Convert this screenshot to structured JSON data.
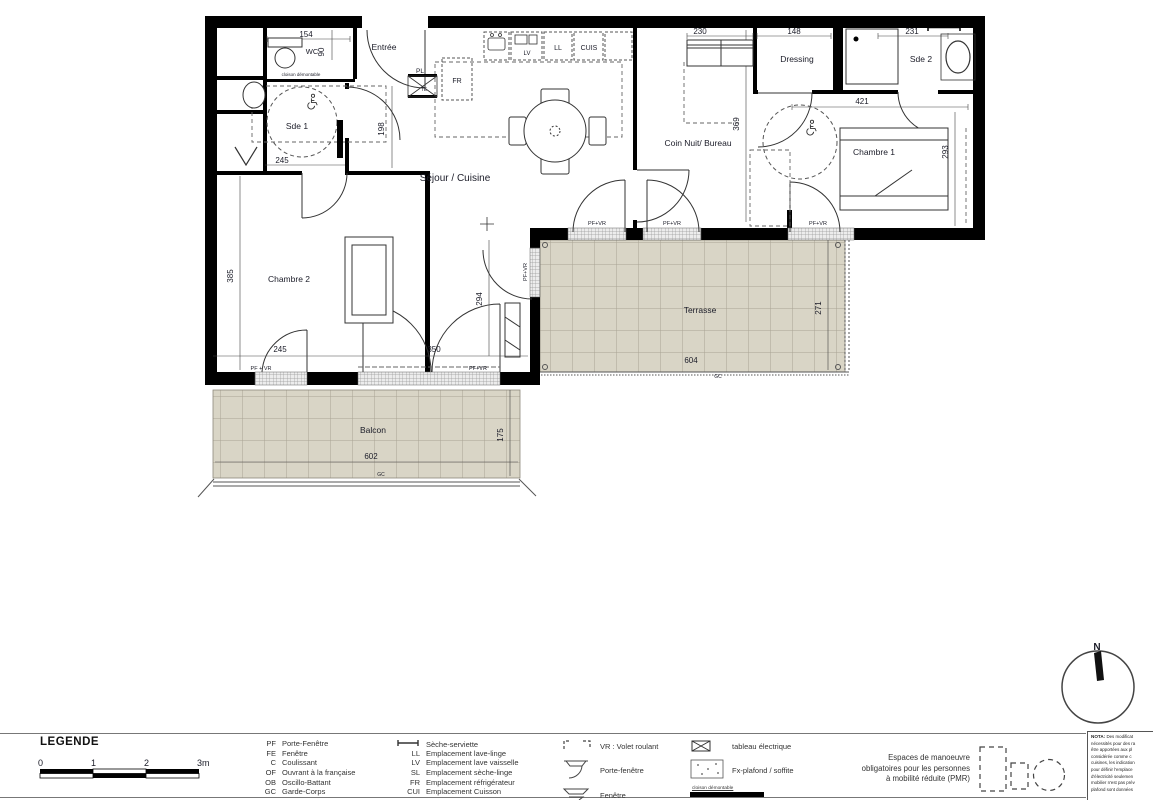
{
  "plan": {
    "rooms": {
      "wc": "WC",
      "entree": "Entrée",
      "sde1": "Sde 1",
      "sejour": "Séjour / Cuisine",
      "coin_nuit": "Coin Nuit/ Bureau",
      "dressing": "Dressing",
      "sde2": "Sde 2",
      "chambre1": "Chambre 1",
      "chambre2": "Chambre 2",
      "terrasse": "Terrasse",
      "balcon": "Balcon"
    },
    "dims": {
      "154": "154",
      "90": "90",
      "198": "198",
      "245": "245",
      "385": "385",
      "350": "350",
      "294": "294",
      "230": "230",
      "369": "369",
      "148": "148",
      "231": "231",
      "421": "421",
      "293": "293",
      "604": "604",
      "271": "271",
      "602": "602",
      "175": "175"
    },
    "tags": {
      "pl": "PL",
      "te": "TE",
      "fr": "FR",
      "lv": "LV",
      "ll": "LL",
      "cuis": "CUIS",
      "gc": "GC",
      "pf_vr": "PF+VR",
      "pf_vr_spaced": "PF + VR",
      "cloison": "cloison démontable",
      "north": "N"
    }
  },
  "legend": {
    "title": "LEGENDE",
    "scale_ticks": [
      "0",
      "1",
      "2",
      "3m"
    ],
    "openings": [
      {
        "abbr": "PF",
        "label": "Porte-Fenêtre"
      },
      {
        "abbr": "FE",
        "label": "Fenêtre"
      },
      {
        "abbr": "C",
        "label": "Coulissant"
      },
      {
        "abbr": "OF",
        "label": "Ouvrant à la française"
      },
      {
        "abbr": "OB",
        "label": "Oscillo-Battant"
      },
      {
        "abbr": "GC",
        "label": "Garde-Corps"
      }
    ],
    "equipment": [
      {
        "abbr": "",
        "label": "Sèche-serviette"
      },
      {
        "abbr": "LL",
        "label": "Emplacement lave-linge"
      },
      {
        "abbr": "LV",
        "label": "Emplacement lave vaisselle"
      },
      {
        "abbr": "SL",
        "label": "Emplacement sèche-linge"
      },
      {
        "abbr": "FR",
        "label": "Emplacement réfrigérateur"
      },
      {
        "abbr": "CUI",
        "label": "Emplacement Cuisson"
      }
    ],
    "symbols": [
      {
        "label": "VR : Volet roulant"
      },
      {
        "label": "Porte-fenêtre"
      },
      {
        "label": "Fenêtre"
      }
    ],
    "symbols2": [
      {
        "label": "tableau électrique"
      },
      {
        "label": "Fx-plafond / soffite"
      },
      {
        "label": "cloison démontable"
      }
    ],
    "pmr": [
      "Espaces de manoeuvre",
      "obligatoires pour les personnes",
      "à mobilité réduite (PMR)"
    ]
  },
  "nota": {
    "prefix": "NOTA:",
    "lines": [
      "Des modificat",
      "nécessités pour des ra",
      "être apportées aux pl",
      "considérée comme c",
      "cuisines, les indication",
      "pour définir l'emplace",
      "d'électricité seulemen",
      "mobilier n'est pas prév",
      "plafond sont données"
    ]
  }
}
